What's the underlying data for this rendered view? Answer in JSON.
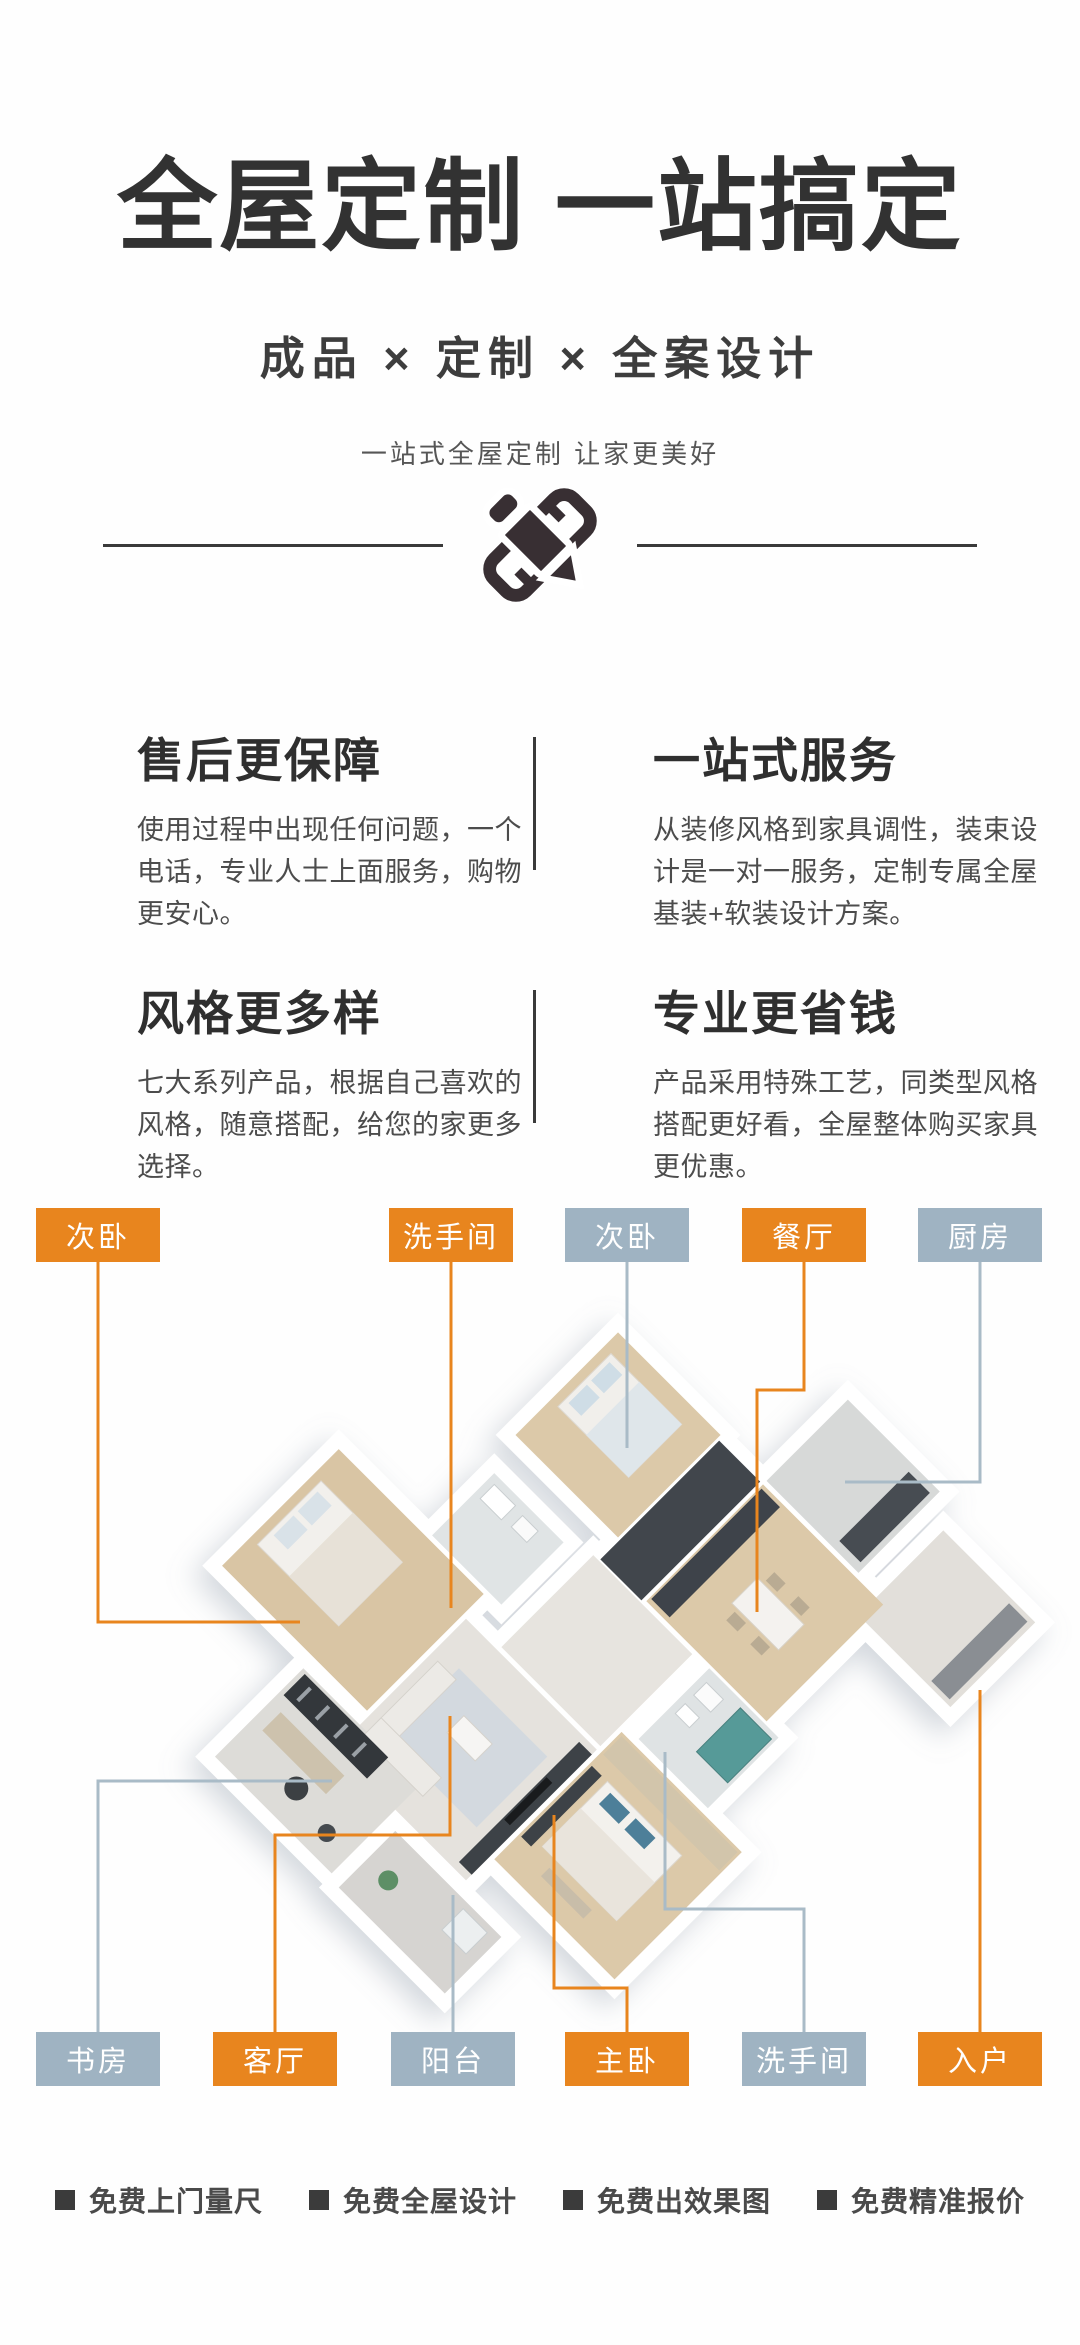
{
  "header": {
    "title": "全屋定制 一站搞定",
    "subtitle": "成品 × 定制 × 全案设计",
    "tagline": "一站式全屋定制 让家更美好"
  },
  "divider_icon": "pencil-and-ruler",
  "features": [
    {
      "title": "售后更保障",
      "desc": "使用过程中出现任何问题，一个电话，专业人士上面服务，购物更安心。"
    },
    {
      "title": "一站式服务",
      "desc": "从装修风格到家具调性，装束设计是一对一服务，定制专属全屋基装+软装设计方案。"
    },
    {
      "title": "风格更多样",
      "desc": "七大系列产品，根据自己喜欢的风格，随意搭配，给您的家更多选择。"
    },
    {
      "title": "专业更省钱",
      "desc": "产品采用特殊工艺，同类型风格搭配更好看，全屋整体购买家具更优惠。"
    }
  ],
  "floorplan": {
    "accent_orange": "#e8851e",
    "accent_gray": "#9fb3c2",
    "labels_top": [
      {
        "text": "次卧",
        "color": "orange"
      },
      {
        "text": "洗手间",
        "color": "orange"
      },
      {
        "text": "次卧",
        "color": "gray"
      },
      {
        "text": "餐厅",
        "color": "orange"
      },
      {
        "text": "厨房",
        "color": "gray"
      }
    ],
    "labels_bottom": [
      {
        "text": "书房",
        "color": "gray"
      },
      {
        "text": "客厅",
        "color": "orange"
      },
      {
        "text": "阳台",
        "color": "gray"
      },
      {
        "text": "主卧",
        "color": "orange"
      },
      {
        "text": "洗手间",
        "color": "gray"
      },
      {
        "text": "入户",
        "color": "orange"
      }
    ]
  },
  "footer": {
    "items": [
      "免费上门量尺",
      "免费全屋设计",
      "免费出效果图",
      "免费精准报价"
    ]
  }
}
